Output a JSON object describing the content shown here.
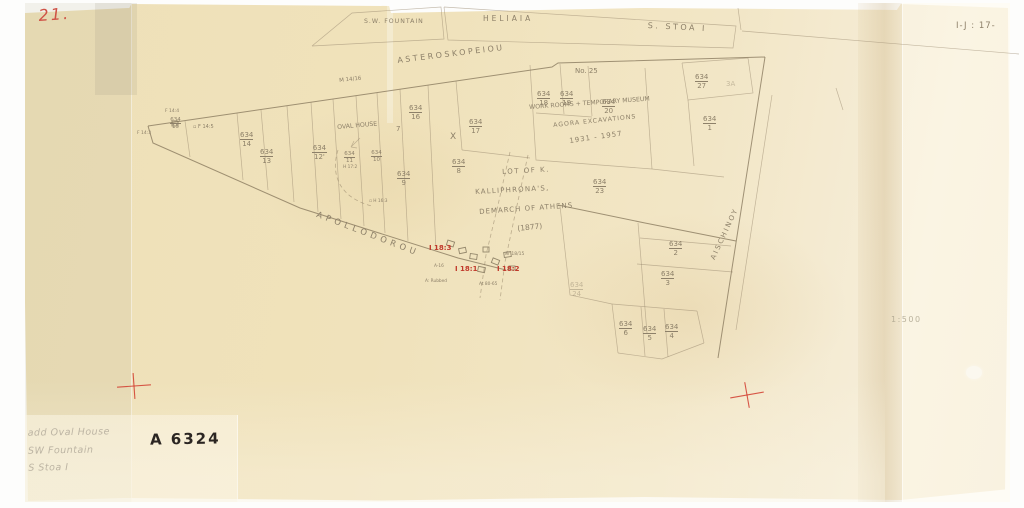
{
  "document": {
    "page_number": "21.",
    "grid_reference": "I-J : 17-",
    "archive_number": "A 6324",
    "scale_label": "1:500"
  },
  "catalog_notes": {
    "lines": [
      "add Oval House",
      "SW Fountain",
      "S Stoa I"
    ]
  },
  "colors": {
    "paper": "#f0e2bb",
    "pencil": "#8d8069",
    "red": "#c0392b",
    "ink": "#2b2522",
    "faint_pencil": "#bcb4a3"
  },
  "labels": [
    {
      "n": "building-sw-fountain",
      "t": "S.W. FOUNTAIN",
      "x": 364,
      "y": 19,
      "s": 6.2,
      "ls": 1
    },
    {
      "n": "building-heliaia",
      "t": "HELIAIA",
      "x": 483,
      "y": 15,
      "s": 7.5,
      "ls": 3
    },
    {
      "n": "building-s-stoa-i",
      "t": "S. STOA  I",
      "x": 648,
      "y": 22,
      "s": 8,
      "ls": 2.5,
      "r": 3
    },
    {
      "n": "street-asteroskopeiou",
      "t": "ASTEROSKOPEIOU",
      "x": 397,
      "y": 57,
      "s": 8,
      "ls": 2.5,
      "r": -7
    },
    {
      "n": "grid-m14-16",
      "t": "M 14/16",
      "x": 339,
      "y": 79,
      "s": 5.5,
      "r": -6
    },
    {
      "n": "parcel-no-25",
      "t": "No. 25",
      "x": 575,
      "y": 68,
      "s": 7
    },
    {
      "n": "note-work-rooms",
      "t": "WORK ROOMS + TEMPORARY MUSEUM",
      "x": 529,
      "y": 105,
      "s": 6.2,
      "r": -4
    },
    {
      "n": "note-agora-excavations",
      "t": "AGORA EXCAVATIONS",
      "x": 553,
      "y": 123,
      "s": 6.2,
      "r": -6,
      "ls": 1
    },
    {
      "n": "note-years",
      "t": "1931 - 1957",
      "x": 569,
      "y": 138,
      "s": 7,
      "r": -8,
      "ls": 1
    },
    {
      "n": "label-oval-house",
      "t": "OVAL HOUSE",
      "x": 337,
      "y": 125,
      "s": 6.2,
      "r": -5
    },
    {
      "n": "mark-x",
      "t": "X",
      "x": 450,
      "y": 133,
      "s": 9
    },
    {
      "n": "mark-7",
      "t": "7",
      "x": 396,
      "y": 126,
      "s": 7
    },
    {
      "n": "lot-note-line-1",
      "t": "LOT  OF  K.",
      "x": 502,
      "y": 169,
      "s": 7,
      "r": -3,
      "ls": 1.5
    },
    {
      "n": "lot-note-line-2",
      "t": "KALLIPHRONA'S,",
      "x": 475,
      "y": 189,
      "s": 7,
      "r": -3,
      "ls": 1.2
    },
    {
      "n": "lot-note-line-3",
      "t": "DEMARCH OF ATHENS",
      "x": 479,
      "y": 209,
      "s": 7,
      "r": -4,
      "ls": 1
    },
    {
      "n": "lot-note-line-4",
      "t": "(1877)",
      "x": 517,
      "y": 225,
      "s": 7.5,
      "r": -6
    },
    {
      "n": "street-apollodorou",
      "t": "APOLLODOROU",
      "x": 318,
      "y": 211,
      "s": 8.5,
      "ls": 4,
      "r": 21
    },
    {
      "n": "street-aischinoy",
      "t": "AISCHINOY",
      "x": 710,
      "y": 258,
      "s": 7,
      "ls": 2,
      "r": -65
    },
    {
      "n": "grid-f14-4",
      "t": "F 14:4",
      "x": 165,
      "y": 110,
      "s": 4.5
    },
    {
      "n": "grid-f14-3",
      "t": "F 14:3",
      "x": 137,
      "y": 132,
      "s": 4.5
    },
    {
      "n": "grid-f14-5",
      "t": "▫ F 14:5",
      "x": 193,
      "y": 125,
      "s": 5
    },
    {
      "n": "grid-h17-2",
      "t": "H 17:2",
      "x": 343,
      "y": 166,
      "s": 4.3
    },
    {
      "n": "grid-h16-3",
      "t": "▫ H 16:3",
      "x": 369,
      "y": 200,
      "s": 4.3
    },
    {
      "n": "mark-3a",
      "t": "3A",
      "x": 726,
      "y": 81,
      "s": 7,
      "o": 0.45
    },
    {
      "n": "well-note-ar",
      "t": "Ar 18/15",
      "x": 505,
      "y": 253,
      "s": 4.5
    },
    {
      "n": "well-note-a16",
      "t": "A-16",
      "x": 434,
      "y": 265,
      "s": 4.3
    },
    {
      "n": "well-note-rubbed",
      "t": "A: Rubbed",
      "x": 425,
      "y": 280,
      "s": 4.3
    },
    {
      "n": "well-note-at",
      "t": "At 80-65",
      "x": 479,
      "y": 283,
      "s": 4.3
    },
    {
      "n": "deposit-i18-3",
      "t": "I 18:3",
      "x": 429,
      "y": 245,
      "s": 7,
      "c": "red",
      "b": 1
    },
    {
      "n": "deposit-i18-1",
      "t": "I 18:1",
      "x": 455,
      "y": 266,
      "s": 7,
      "c": "red",
      "b": 1
    },
    {
      "n": "deposit-i18-2",
      "t": "I 18:2",
      "x": 497,
      "y": 266,
      "s": 7,
      "c": "red",
      "b": 1
    }
  ],
  "fractions": [
    {
      "x": 170,
      "y": 117,
      "num": "634",
      "den": "15",
      "small": 1
    },
    {
      "x": 240,
      "y": 131,
      "num": "634",
      "den": "14"
    },
    {
      "x": 260,
      "y": 148,
      "num": "634",
      "den": "13"
    },
    {
      "x": 312,
      "y": 144,
      "num": "634",
      "den": "12'"
    },
    {
      "x": 344,
      "y": 151,
      "num": "634",
      "den": "11",
      "small": 1
    },
    {
      "x": 371,
      "y": 150,
      "num": "634",
      "den": "10",
      "small": 1
    },
    {
      "x": 397,
      "y": 170,
      "num": "634",
      "den": "9"
    },
    {
      "x": 452,
      "y": 158,
      "num": "634",
      "den": "8"
    },
    {
      "x": 409,
      "y": 104,
      "num": "634",
      "den": "16"
    },
    {
      "x": 469,
      "y": 118,
      "num": "634",
      "den": "17"
    },
    {
      "x": 537,
      "y": 90,
      "num": "634",
      "den": "18"
    },
    {
      "x": 560,
      "y": 90,
      "num": "634",
      "den": "19"
    },
    {
      "x": 602,
      "y": 98,
      "num": "634",
      "den": "20"
    },
    {
      "x": 695,
      "y": 73,
      "num": "634",
      "den": "27"
    },
    {
      "x": 703,
      "y": 115,
      "num": "634",
      "den": "1"
    },
    {
      "x": 593,
      "y": 178,
      "num": "634",
      "den": "23"
    },
    {
      "x": 669,
      "y": 240,
      "num": "634",
      "den": "2"
    },
    {
      "x": 661,
      "y": 270,
      "num": "634",
      "den": "3"
    },
    {
      "x": 570,
      "y": 281,
      "num": "634",
      "den": "24",
      "faint": 1
    },
    {
      "x": 619,
      "y": 320,
      "num": "634",
      "den": "6"
    },
    {
      "x": 643,
      "y": 325,
      "num": "634",
      "den": "5"
    },
    {
      "x": 665,
      "y": 323,
      "num": "634",
      "den": "4"
    }
  ],
  "wells": [
    {
      "x": 447,
      "y": 241,
      "w": 7,
      "h": 5,
      "r": 18
    },
    {
      "x": 459,
      "y": 248,
      "w": 7,
      "h": 5,
      "r": -12
    },
    {
      "x": 470,
      "y": 254,
      "w": 7,
      "h": 5,
      "r": 8
    },
    {
      "x": 483,
      "y": 247,
      "w": 6,
      "h": 5,
      "r": 0
    },
    {
      "x": 492,
      "y": 259,
      "w": 7,
      "h": 5,
      "r": 22
    },
    {
      "x": 504,
      "y": 252,
      "w": 7,
      "h": 5,
      "r": -8
    },
    {
      "x": 478,
      "y": 267,
      "w": 7,
      "h": 5,
      "r": 12
    },
    {
      "x": 509,
      "y": 266,
      "w": 6,
      "h": 4,
      "r": 0
    }
  ],
  "registration_crosses": [
    {
      "x": 134,
      "y": 386,
      "rot": -4
    },
    {
      "x": 747,
      "y": 395,
      "rot": -10
    }
  ]
}
